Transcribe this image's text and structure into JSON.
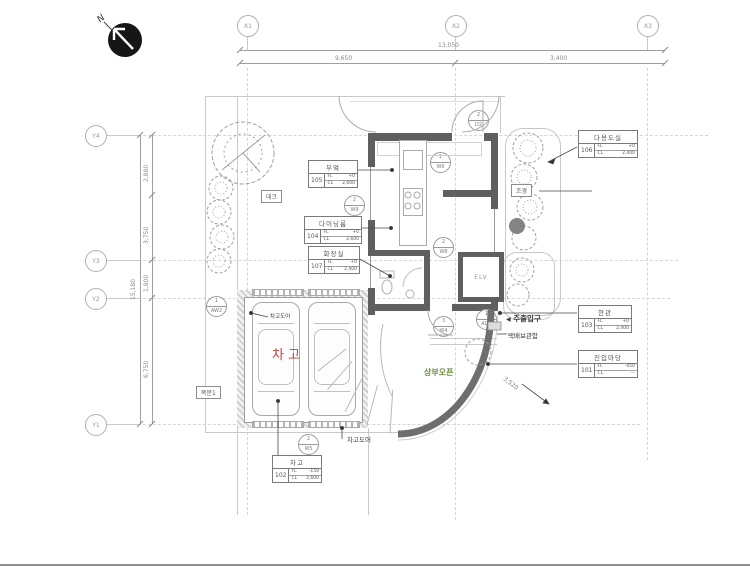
{
  "compass": {
    "label": "N"
  },
  "grid": {
    "x1": "X1",
    "x2": "X2",
    "x3": "X3",
    "y1": "Y1",
    "y2": "Y2",
    "y3": "Y3",
    "y4": "Y4"
  },
  "dims": {
    "top_total": "13,050",
    "top_seg1": "9,650",
    "top_seg2": "3,400",
    "left_total": "15,180",
    "left_seg1": "2,880",
    "left_seg2": "3,750",
    "left_seg3": "1,800",
    "left_seg4": "6,750",
    "ramp": "3,520"
  },
  "rooms": {
    "kitchen": {
      "name": "부엌",
      "no": "105",
      "fl_label": "FL",
      "fl": "+0",
      "cl_label": "CL",
      "cl": "2,600"
    },
    "dining": {
      "name": "다이닝룸",
      "no": "104",
      "fl_label": "FL",
      "fl": "+0",
      "cl_label": "CL",
      "cl": "2,600"
    },
    "bath": {
      "name": "화장실",
      "no": "107",
      "fl_label": "FL",
      "fl": "+0",
      "cl_label": "CL",
      "cl": "2,400"
    },
    "utility": {
      "name": "다용도실",
      "no": "106",
      "fl_label": "FL",
      "fl": "+0",
      "cl_label": "CL",
      "cl": "2,400"
    },
    "entrance": {
      "name": "현관",
      "no": "103",
      "fl_label": "FL",
      "fl": "+0",
      "cl_label": "CL",
      "cl": "2,400"
    },
    "yard": {
      "name": "진입마당",
      "no": "101",
      "fl_label": "FL",
      "fl": "-450",
      "cl_label": "CL",
      "cl": "—"
    },
    "garage": {
      "name": "차고",
      "no": "102",
      "fl_label": "FL",
      "fl": "-150",
      "cl_label": "CL",
      "cl": "2,600"
    }
  },
  "labels": {
    "garage_big": "차고",
    "open_above": "상부오픈",
    "main_entrance": "주출입구",
    "parcel_box": "택배보관함",
    "garage_door_top": "차고도어",
    "garage_door_bottom": "차고도어",
    "side_door": "쪽문1",
    "deck": "데크",
    "landscape": "조경",
    "elevator": "ELV"
  },
  "tags": {
    "t1": {
      "num": "2",
      "code": "W9"
    },
    "t2": {
      "num": "1",
      "code": "W6"
    },
    "t3": {
      "num": "2",
      "code": "W8"
    },
    "t4": {
      "num": "3",
      "code": "W4"
    },
    "t5": {
      "num": "1",
      "code": "AD1"
    },
    "t6": {
      "num": "2",
      "code": "W5"
    },
    "t7": {
      "num": "1",
      "code": "AW2"
    },
    "t8": {
      "num": "2",
      "code": "D2"
    }
  },
  "icons": {
    "entrance_pointer": "◀"
  },
  "colors": {
    "wall": "#5f5f5f",
    "garage_text": "#b4483c",
    "open_above_text": "#6d8f3e",
    "annotation": "#3a3a3a",
    "line_light": "#c9c9c9"
  }
}
